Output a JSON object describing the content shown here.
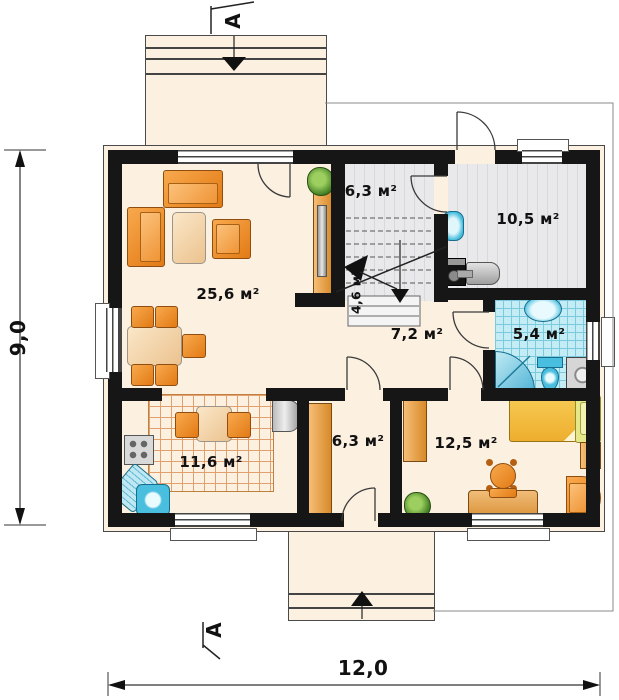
{
  "rooms": {
    "living": {
      "label": "25,6 м²"
    },
    "stair_hall": {
      "label": "6,3 м²"
    },
    "utility": {
      "label": "10,5 м²"
    },
    "under_stair": {
      "label": "4,6 м²"
    },
    "hallway": {
      "label": "7,2 м²"
    },
    "bathroom": {
      "label": "5,4 м²"
    },
    "kitchen": {
      "label": "11,6 м²"
    },
    "vestibule": {
      "label": "6,3 м²"
    },
    "bedroom": {
      "label": "12,5 м²"
    }
  },
  "dimensions": {
    "width": "12,0",
    "height": "9,0"
  },
  "section": {
    "top": "A",
    "bottom": "A"
  },
  "colors": {
    "wall": "#161616",
    "floor": "#fcf0e1",
    "floor_gray": "#e9e9ec",
    "stripe": "#d8d8dd",
    "tile_blue": "#c4ecf5",
    "tile_line": "#7ccade",
    "kgrid": "#e2a06e",
    "accent_orange": "#ef8f2a",
    "fixture_blue": "#49bede",
    "bed_yellow": "#f4c045",
    "pillow_green": "#e6e68b",
    "line": "#333333"
  }
}
